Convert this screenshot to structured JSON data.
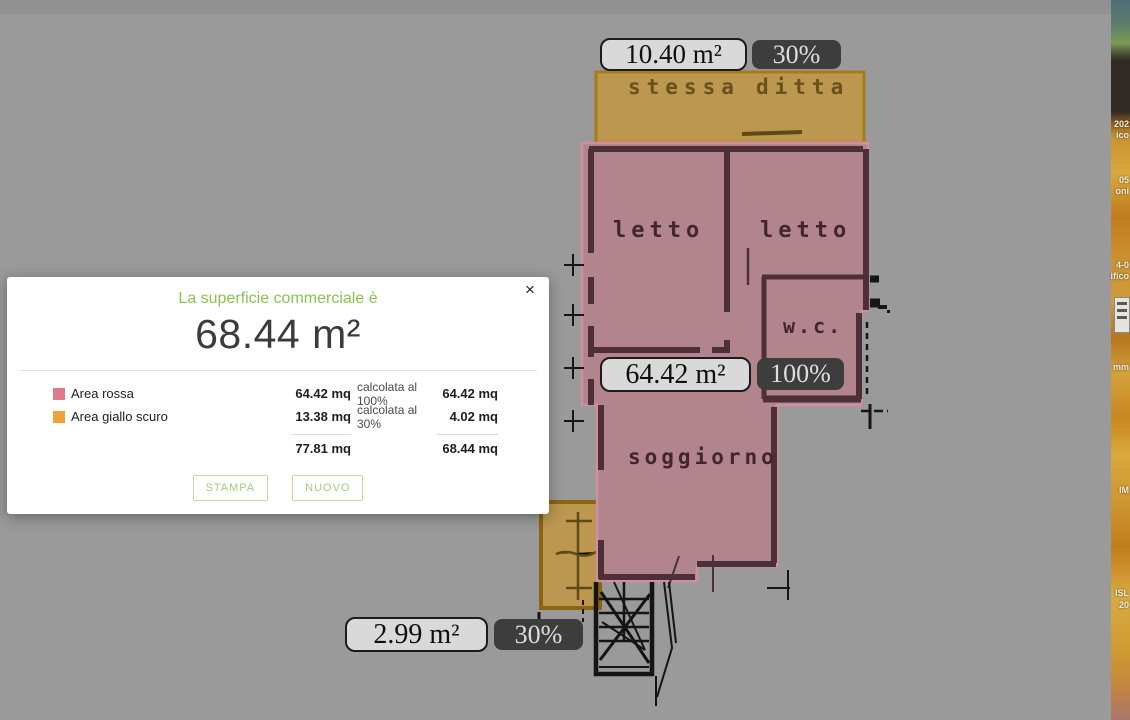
{
  "app": {
    "canvas_color": "#9a9a9a",
    "accent_green": "#8cc152"
  },
  "markers": [
    {
      "area": "10.40 m²",
      "percent": "30%"
    },
    {
      "area": "64.42 m²",
      "percent": "100%"
    },
    {
      "area": "2.99 m²",
      "percent": "30%"
    }
  ],
  "plan": {
    "rooms": {
      "bedroom_left": "letto",
      "bedroom_right": "letto",
      "wc": "w.c.",
      "living": "soggiorno",
      "balcony_word_1": "stessa",
      "balcony_word_2": "ditta"
    },
    "overlay_colors": {
      "pink_fill": "#b2858e",
      "pink_border": "#cf8f9e",
      "orange_fill": "#bb9750",
      "orange_border": "#a87c15"
    }
  },
  "modal": {
    "title": "La superficie commerciale è",
    "total": "68.44 m²",
    "close": "×",
    "rows": [
      {
        "swatch": "#e0798e",
        "label": "Area rossa",
        "qty": "64.42 mq",
        "calc": "calcolata al 100%",
        "result": "64.42 mq"
      },
      {
        "swatch": "#efa239",
        "label": "Area giallo scuro",
        "qty": "13.38 mq",
        "calc": "calcolata al 30%",
        "result": "4.02 mq"
      }
    ],
    "totals": {
      "qty": "77.81 mq",
      "result": "68.44 mq"
    },
    "buttons": {
      "stampa": "STAMPA",
      "nuovo": "NUOVO"
    }
  },
  "strip": {
    "fragments": [
      "202",
      "ico",
      "05",
      "oni",
      "4-0",
      "ifico",
      "mm",
      "IM",
      "ISL",
      "20"
    ]
  }
}
